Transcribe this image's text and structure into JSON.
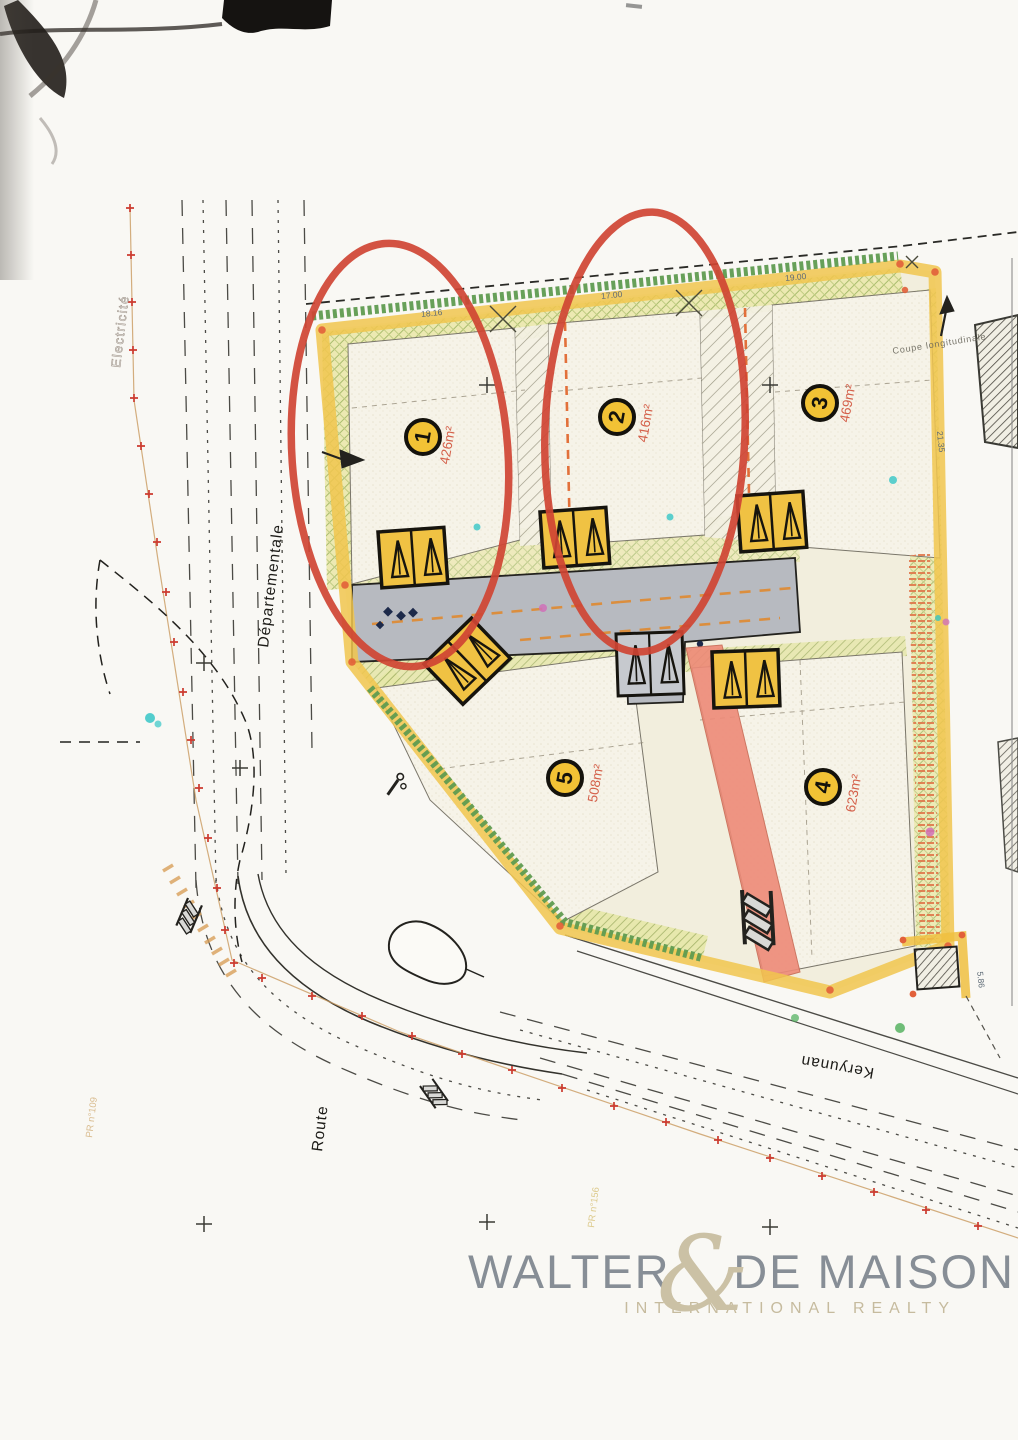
{
  "plan": {
    "lots": [
      {
        "number": "1",
        "area": "426m²"
      },
      {
        "number": "2",
        "area": "416m²"
      },
      {
        "number": "3",
        "area": "469m²"
      },
      {
        "number": "4",
        "area": "623m²"
      },
      {
        "number": "5",
        "area": "508m²"
      }
    ],
    "streets": {
      "route": "Route",
      "departementale": "Départementale",
      "keryunan": "Keryunan"
    },
    "labels": {
      "coupe": "Coupe longitudinale",
      "utility_line": "Electricité",
      "marker_left": "PR n°109",
      "marker_bottom": "PR n°156"
    },
    "dimensions": {
      "top_1": "18.16",
      "top_2": "17.00",
      "top_3": "19.00",
      "right_side": "21.35",
      "transformer": "5.86"
    }
  },
  "watermark": {
    "name_left": "WALTER",
    "ampersand": "&",
    "name_right": "DE MAISON",
    "tagline": "INTERNATIONAL REALTY"
  },
  "colors": {
    "highlight_red": "#cf4433",
    "lot_badge_yellow": "#f2c235",
    "boundary_yellow": "#f1c64e",
    "hedge_green": "#5f9b50",
    "road_gray": "#b7bac0",
    "path_pink": "#ee8a78",
    "area_label_red": "#d4604a",
    "watermark_gray": "#878e96",
    "watermark_tan": "#c6bb9e"
  }
}
